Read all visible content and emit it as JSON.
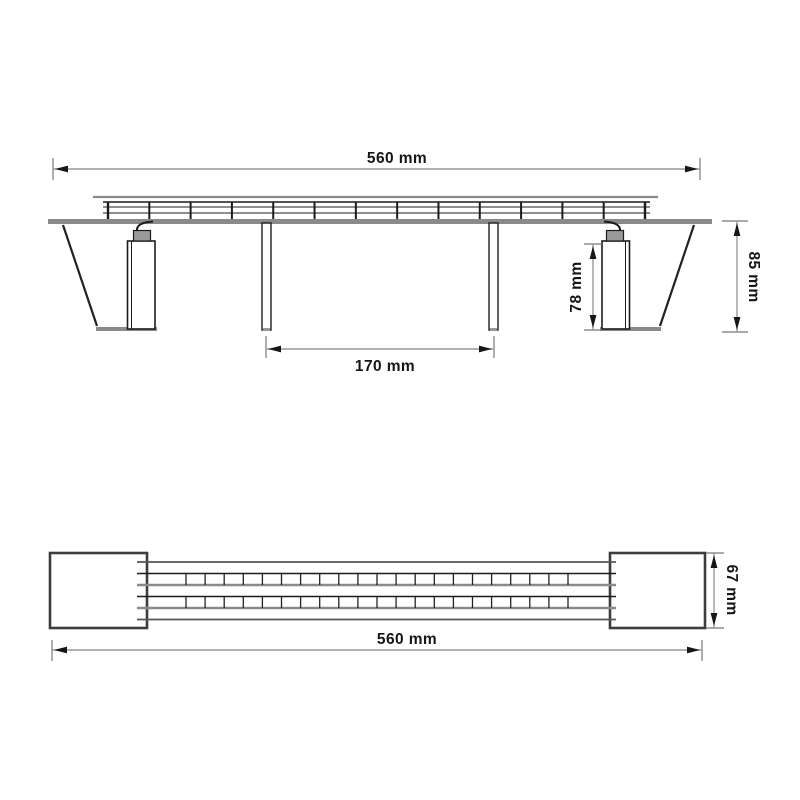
{
  "drawing": {
    "colors": {
      "primary_line": "#1c1c1c",
      "secondary_line": "#8a8a8a",
      "dimension_line": "#777777",
      "arrow": "#161616",
      "background": "#ffffff"
    },
    "views": {
      "side_elevation": {
        "dimensions": {
          "overall_width": "560 mm",
          "overall_height": "85 mm",
          "pier_height": "78 mm",
          "center_span": "170 mm"
        }
      },
      "plan_view": {
        "dimensions": {
          "overall_width": "560 mm",
          "deck_width": "67 mm"
        }
      }
    }
  }
}
